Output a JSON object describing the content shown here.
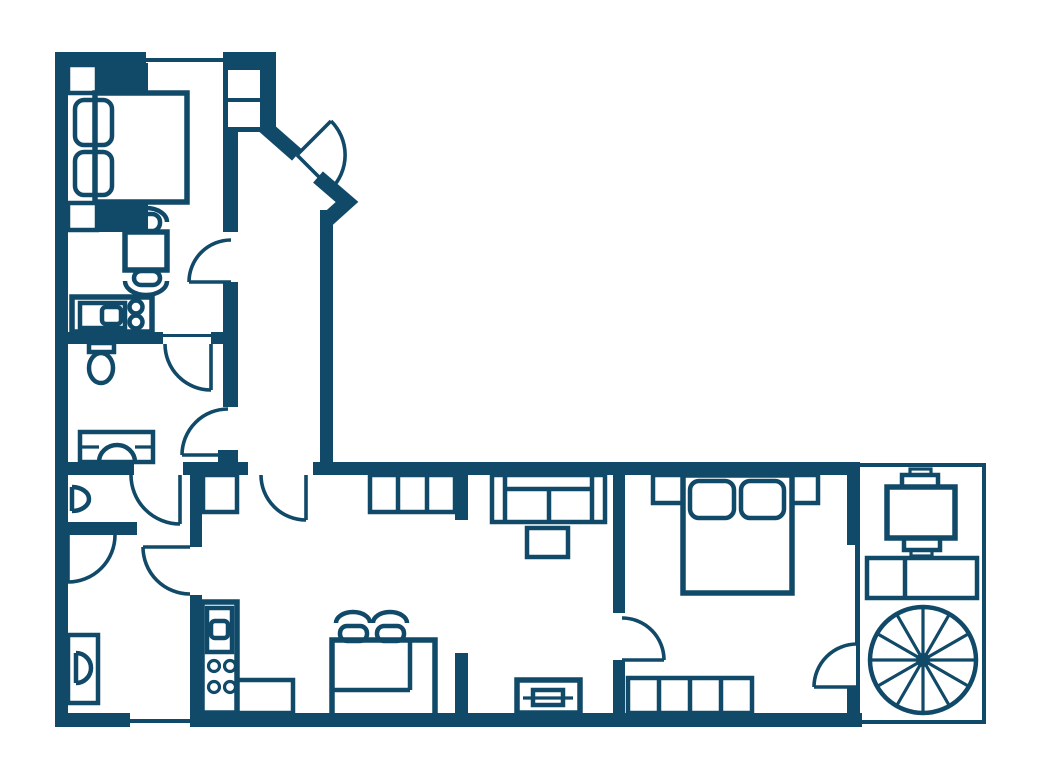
{
  "meta": {
    "title": "Apartment floor plan",
    "drawing_type": "floor-plan",
    "text_labels": []
  },
  "palette": {
    "wall_color": "#114a68",
    "background": "#ffffff"
  },
  "canvas": {
    "width": 1040,
    "height": 780
  },
  "structure": {
    "windows": [
      "top-wall-window",
      "bottom-wall-window"
    ],
    "doors": [
      "entry-door-diagonal",
      "bedroom-top-door",
      "bedroom-to-bathroom-door",
      "hall-to-bathroom-door",
      "hall-to-living-door",
      "bathroom-to-wc-door",
      "wc-to-study-door",
      "kitchen-to-study-door",
      "living-to-bedroom-door",
      "bedroom-to-stair-area-door"
    ],
    "partitions": [
      "glass-partition-bedroom-right",
      "stub-partition-top",
      "stub-partition-bottom"
    ]
  },
  "areas": {
    "bedroom_top_left": {
      "icons": [
        "double-bed-icon",
        "pillow-icon",
        "pillow-icon",
        "nightstand-icon",
        "nightstand-icon",
        "shelf-block-icon",
        "shelf-block-icon",
        "closet-niche-icon",
        "side-table-icon",
        "chair-icon",
        "chair-icon",
        "kitchenette-counter-icon",
        "oven-icon",
        "burner-icon",
        "burner-icon"
      ]
    },
    "bathroom": {
      "icons": [
        "toilet-icon",
        "sink-icon"
      ]
    },
    "wc": {
      "icons": [
        "washbasin-icon"
      ]
    },
    "study_lower_left": {
      "icons": [
        "wall-sink-icon"
      ]
    },
    "kitchen_living": {
      "icons": [
        "cabinet-icon",
        "sideboard-icon",
        "sofa-icon",
        "coffee-table-icon",
        "bar-counter-icon",
        "stool-icon",
        "stool-icon",
        "stove-unit-icon",
        "counter-icon",
        "radiator-icon"
      ]
    },
    "bedroom_right": {
      "icons": [
        "double-bed-icon",
        "pillow-icon",
        "pillow-icon",
        "nightstand-icon",
        "nightstand-icon",
        "wardrobe-icon"
      ]
    },
    "stair_terrace": {
      "icons": [
        "dining-table-icon",
        "chair-icon",
        "chair-icon",
        "cabinet-icon",
        "spiral-staircase-icon"
      ]
    }
  }
}
